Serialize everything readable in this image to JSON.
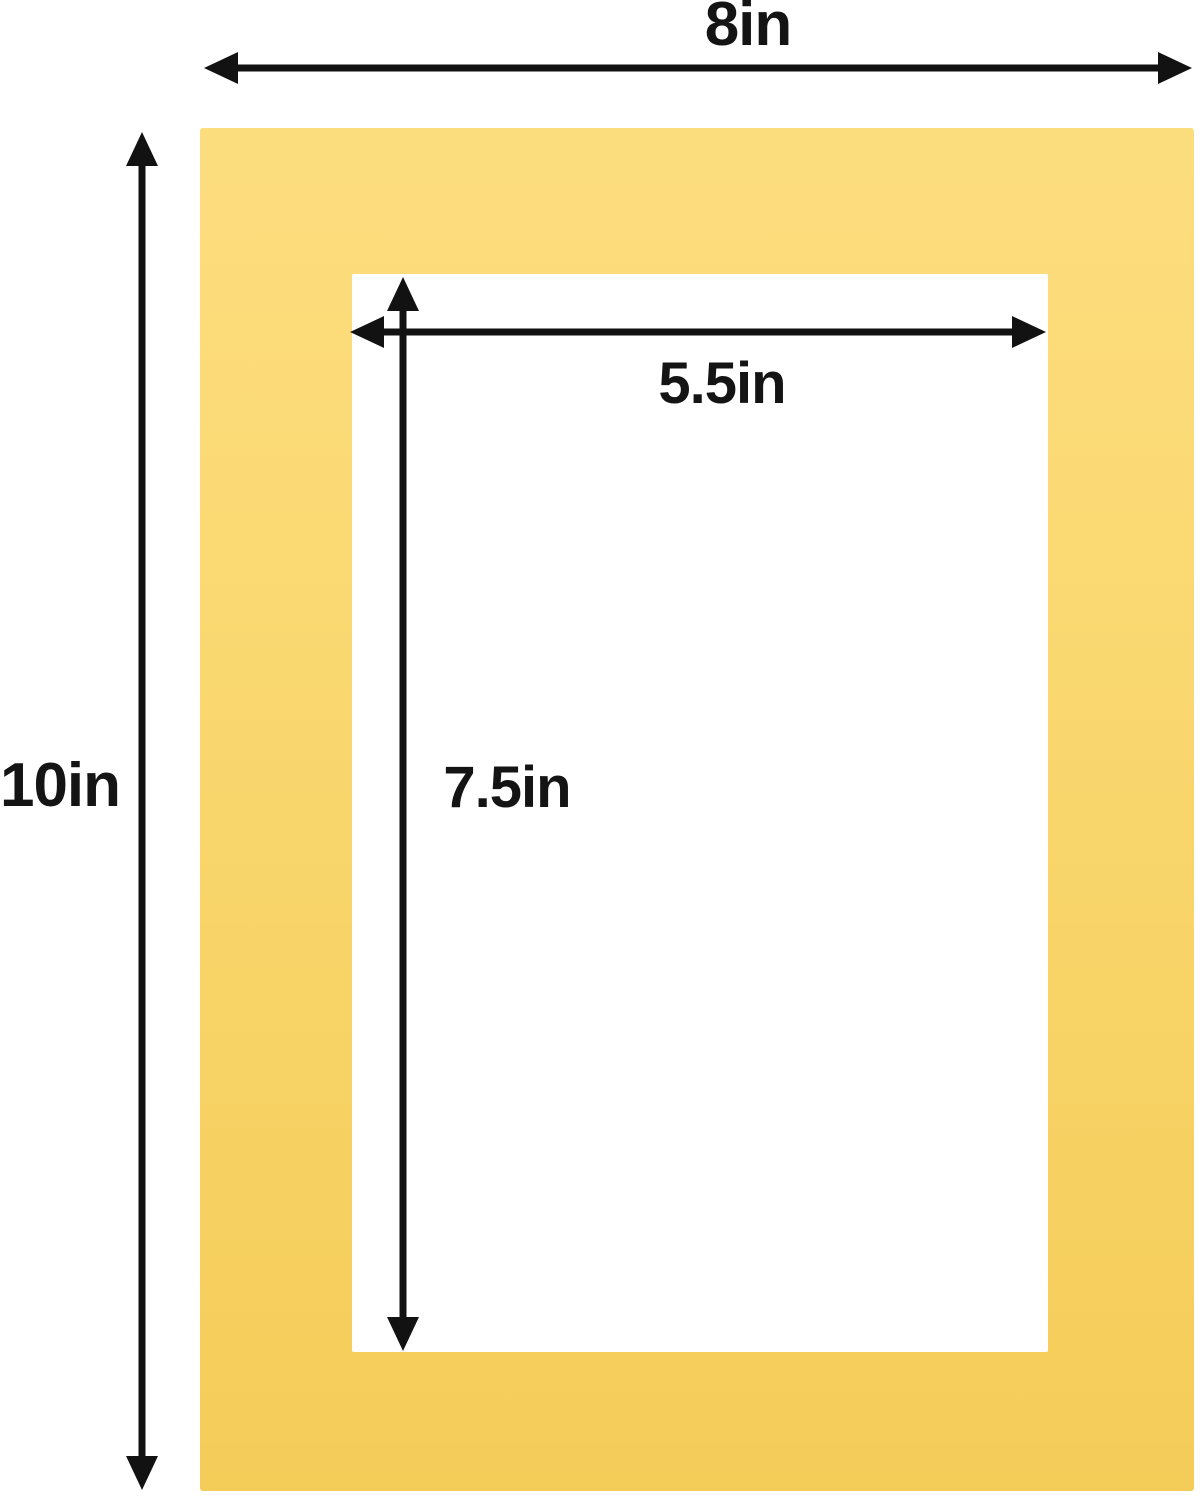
{
  "diagram": {
    "title": "mat-board-dimension-diagram",
    "mat": {
      "outer": {
        "width_label": "8in",
        "height_label": "10in"
      },
      "opening": {
        "width_label": "5.5in",
        "height_label": "7.5in"
      }
    },
    "colors": {
      "mat_yellow_top": "#fbda74",
      "mat_yellow_bottom": "#f4cc58",
      "arrow_black": "#121212",
      "label_text": "#141414",
      "background": "#ffffff",
      "opening_white": "#ffffff"
    }
  }
}
